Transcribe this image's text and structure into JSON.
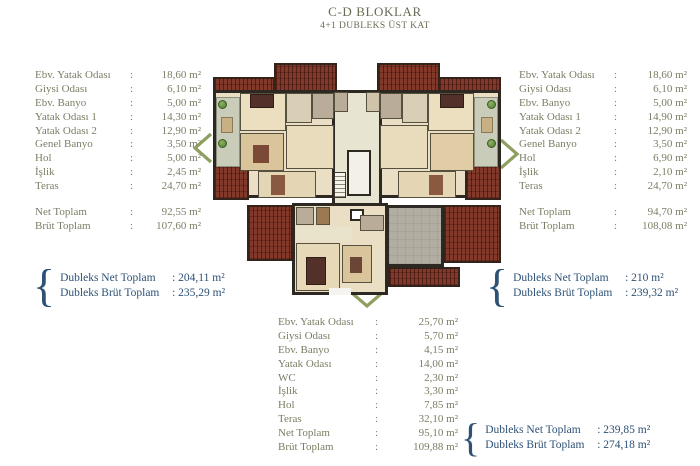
{
  "title": {
    "line1": "C-D BLOKLAR",
    "line2": "4+1 DUBLEKS ÜST KAT"
  },
  "brace": "{",
  "colors": {
    "list_text": "#7b7e64",
    "title_text": "#686c52",
    "duplex_text": "#2e5175",
    "roof_red": "#83392a",
    "wall_dark": "#2d2822",
    "floor_beige": "#eadfc4",
    "terrace_sage": "#c9ccb8",
    "terrace_gray": "#b2ada1",
    "arrow_green": "#8f9f5f"
  },
  "unit_left": {
    "rows": [
      {
        "label": "Ebv. Yatak Odası",
        "value": "18,60 m²"
      },
      {
        "label": "Giysi Odası",
        "value": "6,10 m²"
      },
      {
        "label": "Ebv. Banyo",
        "value": "5,00 m²"
      },
      {
        "label": "Yatak Odası 1",
        "value": "14,30 m²"
      },
      {
        "label": "Yatak Odası 2",
        "value": "12,90 m²"
      },
      {
        "label": "Genel Banyo",
        "value": "3,50 m²"
      },
      {
        "label": "Hol",
        "value": "5,00 m²"
      },
      {
        "label": "İşlik",
        "value": "2,45 m²"
      },
      {
        "label": "Teras",
        "value": "24,70 m²"
      }
    ],
    "totals": [
      {
        "label": "Net Toplam",
        "value": "92,55 m²"
      },
      {
        "label": "Brüt Toplam",
        "value": "107,60 m²"
      }
    ],
    "duplex": [
      {
        "label": "Dubleks Net Toplam",
        "value": "204,11 m²"
      },
      {
        "label": "Dubleks Brüt Toplam",
        "value": "235,29 m²"
      }
    ]
  },
  "unit_right": {
    "rows": [
      {
        "label": "Ebv. Yatak Odası",
        "value": "18,60 m²"
      },
      {
        "label": "Giysi Odası",
        "value": "6,10 m²"
      },
      {
        "label": "Ebv. Banyo",
        "value": "5,00 m²"
      },
      {
        "label": "Yatak Odası 1",
        "value": "14,90 m²"
      },
      {
        "label": "Yatak Odası 2",
        "value": "12,90 m²"
      },
      {
        "label": "Genel Banyo",
        "value": "3,50 m²"
      },
      {
        "label": "Hol",
        "value": "6,90 m²"
      },
      {
        "label": "İşlik",
        "value": "2,10 m²"
      },
      {
        "label": "Teras",
        "value": "24,70 m²"
      }
    ],
    "totals": [
      {
        "label": "Net Toplam",
        "value": "94,70 m²"
      },
      {
        "label": "Brüt Toplam",
        "value": "108,08 m²"
      }
    ],
    "duplex": [
      {
        "label": "Dubleks Net Toplam",
        "value": "210 m²"
      },
      {
        "label": "Dubleks Brüt Toplam",
        "value": "239,32 m²"
      }
    ]
  },
  "unit_lower": {
    "rows": [
      {
        "label": "Ebv. Yatak Odası",
        "value": "25,70 m²"
      },
      {
        "label": "Giysi Odası",
        "value": "5,70 m²"
      },
      {
        "label": "Ebv. Banyo",
        "value": "4,15 m²"
      },
      {
        "label": "Yatak Odası",
        "value": "14,00 m²"
      },
      {
        "label": "WC",
        "value": "2,30 m²"
      },
      {
        "label": "İşlik",
        "value": "3,30 m²"
      },
      {
        "label": "Hol",
        "value": "7,85 m²"
      },
      {
        "label": "Teras",
        "value": "32,10 m²"
      }
    ],
    "totals": [
      {
        "label": "Net Toplam",
        "value": "95,10 m²"
      },
      {
        "label": "Brüt Toplam",
        "value": "109,88 m²"
      }
    ],
    "duplex": [
      {
        "label": "Dubleks Net Toplam",
        "value": "239,85 m²"
      },
      {
        "label": "Dubleks Brüt Toplam",
        "value": "274,18 m²"
      }
    ]
  }
}
